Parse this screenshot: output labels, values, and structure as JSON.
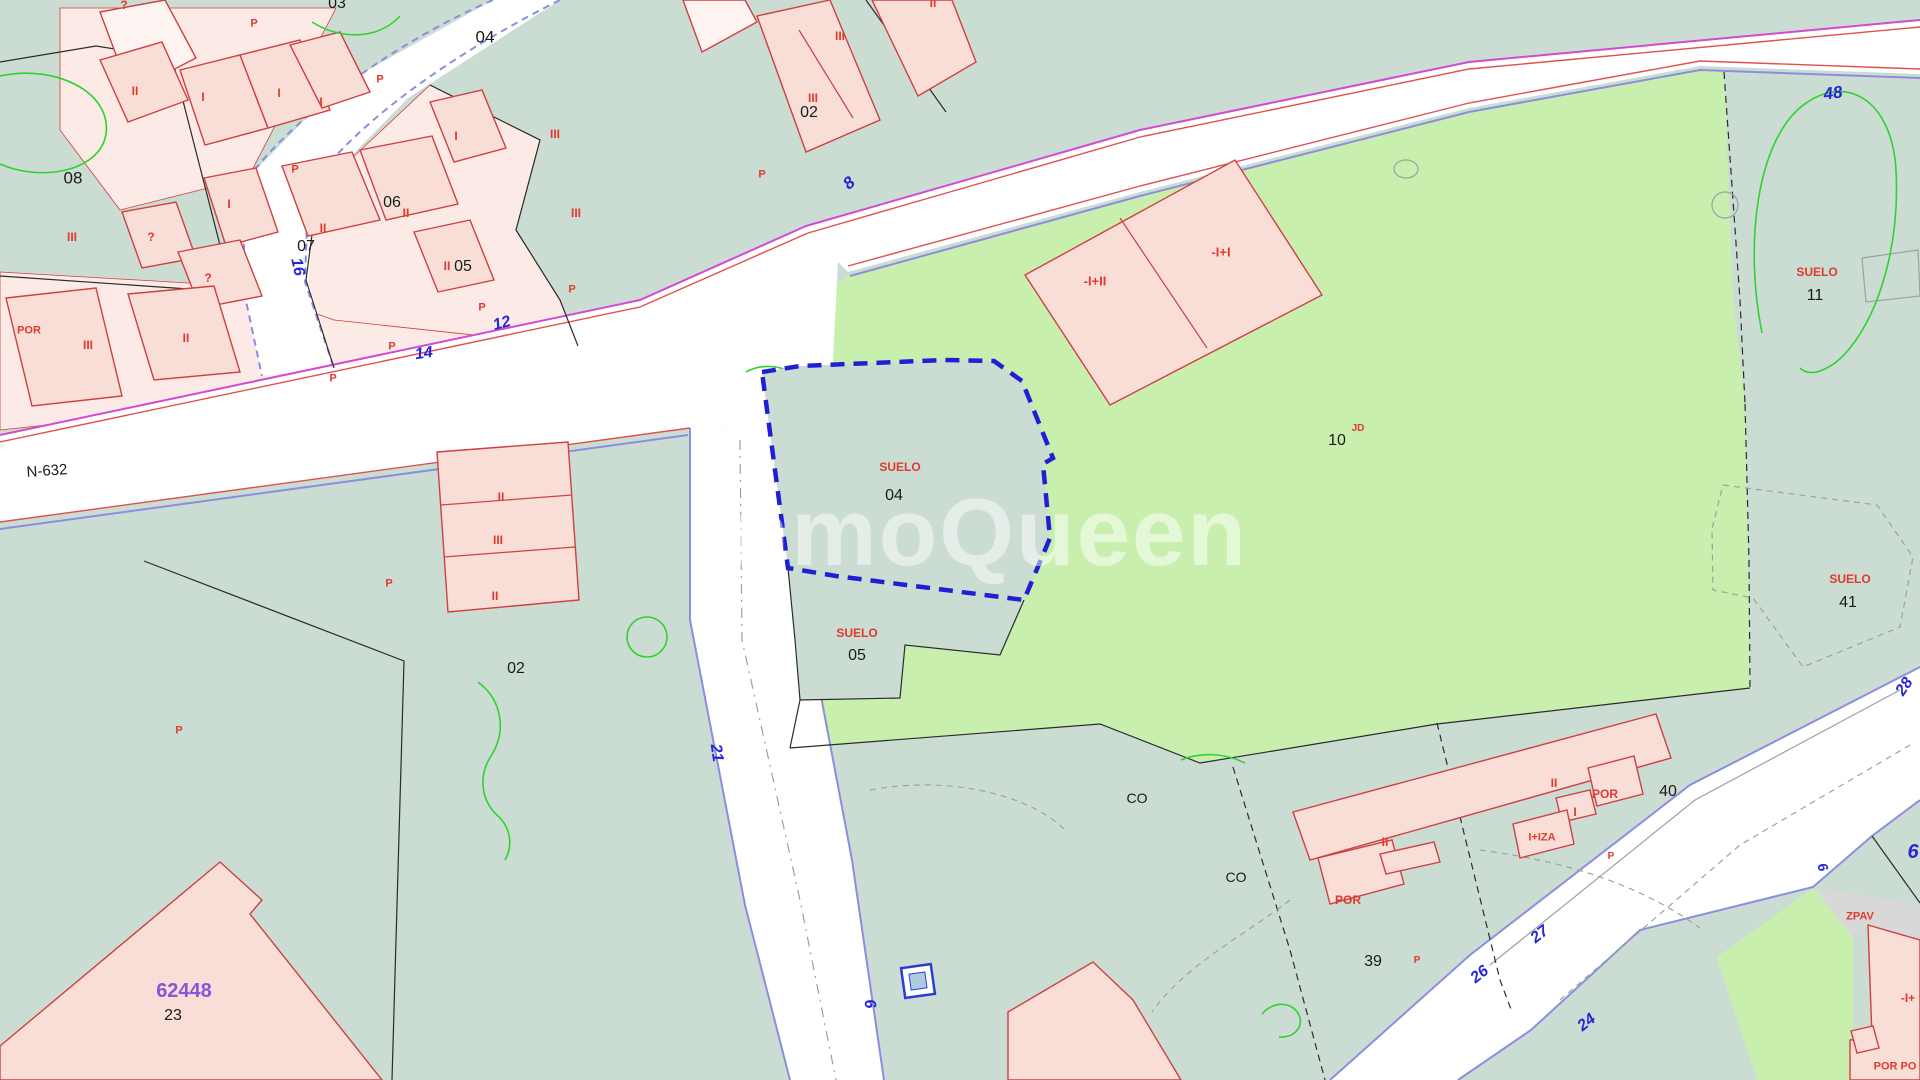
{
  "map": {
    "watermark_text": "InmoQueen",
    "colors": {
      "teal": "#cbdcd3",
      "light_green": "#c9efae",
      "road": "#ffffff",
      "parcel_pink": "#fbeae5",
      "building_pink": "#f8ded7",
      "building_outline": "#cf4040",
      "boundary": "#2b2b2b",
      "magenta": "#d24ad2",
      "red_edge": "#e05050",
      "violet": "#8d8de0",
      "selected_blue": "#1f1fd4",
      "label_black": "#1a1a1a",
      "label_red": "#e03a2f",
      "label_blue": "#2626d8",
      "label_purple": "#8756d6",
      "gray_fill": "#d8d8d8",
      "gray_line": "#9aa39e",
      "vegetation_green": "#2ed32e",
      "watermark_white": "#ffffff"
    },
    "selected_parcel": {
      "land_label": "SUELO",
      "number": "04"
    },
    "road_name": "N-632",
    "labels": [
      {
        "n": "parcel-number-03",
        "t": "03",
        "x": 337,
        "y": 4,
        "c": "black",
        "s": 16
      },
      {
        "n": "parcel-number-04",
        "t": "04",
        "x": 485,
        "y": 37,
        "c": "black",
        "s": 17
      },
      {
        "n": "parcel-number-08",
        "t": "08",
        "x": 73,
        "y": 178,
        "c": "black",
        "s": 17
      },
      {
        "n": "parcel-number-06",
        "t": "06",
        "x": 392,
        "y": 203,
        "c": "black",
        "s": 16
      },
      {
        "n": "parcel-number-07",
        "t": "07",
        "x": 306,
        "y": 247,
        "c": "black",
        "s": 16
      },
      {
        "n": "parcel-number-05",
        "t": "05",
        "x": 463,
        "y": 267,
        "c": "black",
        "s": 16
      },
      {
        "n": "parcel-number-02-top",
        "t": "02",
        "x": 809,
        "y": 113,
        "c": "black",
        "s": 16
      },
      {
        "n": "parcel-number-02",
        "t": "02",
        "x": 516,
        "y": 669,
        "c": "black",
        "s": 16
      },
      {
        "n": "suelo-04-label",
        "t": "SUELO",
        "x": 900,
        "y": 467,
        "c": "red",
        "s": 12
      },
      {
        "n": "parcel-number-04-suelo",
        "t": "04",
        "x": 894,
        "y": 496,
        "c": "black",
        "s": 16
      },
      {
        "n": "suelo-05-label",
        "t": "SUELO",
        "x": 857,
        "y": 633,
        "c": "red",
        "s": 12
      },
      {
        "n": "parcel-number-05-suelo",
        "t": "05",
        "x": 857,
        "y": 656,
        "c": "black",
        "s": 16
      },
      {
        "n": "parcel-number-10",
        "t": "10",
        "x": 1337,
        "y": 441,
        "c": "black",
        "s": 16
      },
      {
        "n": "landuse-jd",
        "t": "JD",
        "x": 1358,
        "y": 429,
        "c": "red",
        "s": 10
      },
      {
        "n": "suelo-11-label",
        "t": "SUELO",
        "x": 1817,
        "y": 272,
        "c": "red",
        "s": 12
      },
      {
        "n": "parcel-number-11",
        "t": "11",
        "x": 1815,
        "y": 296,
        "c": "black",
        "s": 16
      },
      {
        "n": "suelo-41-label",
        "t": "SUELO",
        "x": 1850,
        "y": 579,
        "c": "red",
        "s": 12
      },
      {
        "n": "parcel-number-41",
        "t": "41",
        "x": 1848,
        "y": 603,
        "c": "black",
        "s": 16
      },
      {
        "n": "parcel-number-40",
        "t": "40",
        "x": 1668,
        "y": 792,
        "c": "black",
        "s": 16
      },
      {
        "n": "parcel-number-39",
        "t": "39",
        "x": 1373,
        "y": 962,
        "c": "black",
        "s": 16
      },
      {
        "n": "parcel-number-23",
        "t": "23",
        "x": 173,
        "y": 1016,
        "c": "black",
        "s": 16
      },
      {
        "n": "cadastral-ref-62448",
        "t": "62448",
        "x": 184,
        "y": 991,
        "c": "purple",
        "s": 20
      },
      {
        "n": "landuse-co-1",
        "t": "CO",
        "x": 1137,
        "y": 798,
        "c": "black",
        "s": 14
      },
      {
        "n": "landuse-co-2",
        "t": "CO",
        "x": 1236,
        "y": 877,
        "c": "black",
        "s": 14
      },
      {
        "n": "road-name-n632",
        "t": "N-632",
        "x": 47,
        "y": 471,
        "c": "black",
        "s": 15,
        "r": -4
      },
      {
        "n": "mark-q-1",
        "t": "?",
        "x": 124,
        "y": 5,
        "c": "red",
        "s": 12
      },
      {
        "n": "ground-mark-p-1",
        "t": "P",
        "x": 254,
        "y": 24,
        "c": "red",
        "s": 11
      },
      {
        "n": "ground-mark-p-2",
        "t": "P",
        "x": 380,
        "y": 80,
        "c": "red",
        "s": 11
      },
      {
        "n": "floors-ii-1",
        "t": "II",
        "x": 135,
        "y": 91,
        "c": "red",
        "s": 12
      },
      {
        "n": "floors-i-1",
        "t": "I",
        "x": 203,
        "y": 97,
        "c": "red",
        "s": 12
      },
      {
        "n": "floors-i-2",
        "t": "I",
        "x": 279,
        "y": 93,
        "c": "red",
        "s": 12
      },
      {
        "n": "floors-i-3",
        "t": "I",
        "x": 321,
        "y": 102,
        "c": "red",
        "s": 12
      },
      {
        "n": "floors-i-4",
        "t": "I",
        "x": 456,
        "y": 136,
        "c": "red",
        "s": 12
      },
      {
        "n": "ground-mark-p-3",
        "t": "P",
        "x": 295,
        "y": 170,
        "c": "red",
        "s": 11
      },
      {
        "n": "floors-i-5",
        "t": "I",
        "x": 229,
        "y": 204,
        "c": "red",
        "s": 12
      },
      {
        "n": "floors-ii-2",
        "t": "II",
        "x": 406,
        "y": 213,
        "c": "red",
        "s": 12
      },
      {
        "n": "floors-ii-3",
        "t": "II",
        "x": 323,
        "y": 228,
        "c": "red",
        "s": 12
      },
      {
        "n": "floors-iii-1",
        "t": "III",
        "x": 72,
        "y": 237,
        "c": "red",
        "s": 12
      },
      {
        "n": "mark-q-2",
        "t": "?",
        "x": 151,
        "y": 237,
        "c": "red",
        "s": 12
      },
      {
        "n": "floors-ii-4",
        "t": "II",
        "x": 447,
        "y": 266,
        "c": "red",
        "s": 12
      },
      {
        "n": "mark-q-3",
        "t": "?",
        "x": 208,
        "y": 278,
        "c": "red",
        "s": 12
      },
      {
        "n": "floors-por-1",
        "t": "POR",
        "x": 29,
        "y": 331,
        "c": "red",
        "s": 11
      },
      {
        "n": "floors-iii-2",
        "t": "III",
        "x": 88,
        "y": 345,
        "c": "red",
        "s": 12
      },
      {
        "n": "floors-ii-5",
        "t": "II",
        "x": 186,
        "y": 338,
        "c": "red",
        "s": 12
      },
      {
        "n": "ground-mark-p-4",
        "t": "P",
        "x": 482,
        "y": 308,
        "c": "red",
        "s": 11
      },
      {
        "n": "ground-mark-p-5",
        "t": "P",
        "x": 333,
        "y": 379,
        "c": "red",
        "s": 11
      },
      {
        "n": "ground-mark-p-6",
        "t": "P",
        "x": 392,
        "y": 347,
        "c": "red",
        "s": 11
      },
      {
        "n": "floors-iii-3",
        "t": "III",
        "x": 555,
        "y": 134,
        "c": "red",
        "s": 12
      },
      {
        "n": "floors-iii-4",
        "t": "III",
        "x": 576,
        "y": 213,
        "c": "red",
        "s": 12
      },
      {
        "n": "ground-mark-p-7",
        "t": "P",
        "x": 572,
        "y": 290,
        "c": "red",
        "s": 11
      },
      {
        "n": "floors-iii-5",
        "t": "III",
        "x": 840,
        "y": 36,
        "c": "red",
        "s": 12
      },
      {
        "n": "floors-iii-6",
        "t": "III",
        "x": 813,
        "y": 98,
        "c": "red",
        "s": 12
      },
      {
        "n": "floors-ii-6",
        "t": "II",
        "x": 933,
        "y": 3,
        "c": "red",
        "s": 12
      },
      {
        "n": "ground-mark-p-8",
        "t": "P",
        "x": 762,
        "y": 175,
        "c": "red",
        "s": 11
      },
      {
        "n": "floors-ii-7",
        "t": "II",
        "x": 501,
        "y": 497,
        "c": "red",
        "s": 12
      },
      {
        "n": "floors-iii-7",
        "t": "III",
        "x": 498,
        "y": 540,
        "c": "red",
        "s": 12
      },
      {
        "n": "floors-ii-8",
        "t": "II",
        "x": 495,
        "y": 596,
        "c": "red",
        "s": 12
      },
      {
        "n": "ground-mark-p-9",
        "t": "P",
        "x": 389,
        "y": 584,
        "c": "red",
        "s": 11
      },
      {
        "n": "ground-mark-p-10",
        "t": "P",
        "x": 179,
        "y": 731,
        "c": "red",
        "s": 11
      },
      {
        "n": "floors-neg-i-ii",
        "t": "-I+II",
        "x": 1095,
        "y": 281,
        "c": "red",
        "s": 13
      },
      {
        "n": "floors-neg-i-i",
        "t": "-I+I",
        "x": 1221,
        "y": 252,
        "c": "red",
        "s": 13
      },
      {
        "n": "floors-ii-9",
        "t": "II",
        "x": 1554,
        "y": 783,
        "c": "red",
        "s": 12
      },
      {
        "n": "floors-por-2",
        "t": "POR",
        "x": 1605,
        "y": 794,
        "c": "red",
        "s": 12
      },
      {
        "n": "floors-i-6",
        "t": "I",
        "x": 1575,
        "y": 812,
        "c": "red",
        "s": 12
      },
      {
        "n": "floors-i-iza",
        "t": "I+IZA",
        "x": 1542,
        "y": 838,
        "c": "red",
        "s": 11
      },
      {
        "n": "floors-ii-10",
        "t": "II",
        "x": 1385,
        "y": 842,
        "c": "red",
        "s": 12
      },
      {
        "n": "floors-por-3",
        "t": "POR",
        "x": 1348,
        "y": 900,
        "c": "red",
        "s": 12
      },
      {
        "n": "ground-mark-p-11",
        "t": "P",
        "x": 1611,
        "y": 857,
        "c": "red",
        "s": 10
      },
      {
        "n": "ground-mark-p-12",
        "t": "P",
        "x": 1417,
        "y": 961,
        "c": "red",
        "s": 10
      },
      {
        "n": "landuse-zpav",
        "t": "ZPAV",
        "x": 1860,
        "y": 917,
        "c": "red",
        "s": 11
      },
      {
        "n": "floors-neg-i",
        "t": "-I+",
        "x": 1908,
        "y": 998,
        "c": "red",
        "s": 12
      },
      {
        "n": "floors-por-4",
        "t": "POR PO",
        "x": 1895,
        "y": 1067,
        "c": "red",
        "s": 11
      },
      {
        "n": "street-number-16",
        "t": "16",
        "x": 297,
        "y": 267,
        "c": "blue",
        "s": 16,
        "r": 78
      },
      {
        "n": "street-number-14",
        "t": "14",
        "x": 424,
        "y": 354,
        "c": "blue",
        "s": 16,
        "r": -8
      },
      {
        "n": "street-number-12",
        "t": "12",
        "x": 502,
        "y": 324,
        "c": "blue",
        "s": 16,
        "r": -15
      },
      {
        "n": "street-number-8",
        "t": "8",
        "x": 849,
        "y": 183,
        "c": "blue",
        "s": 17,
        "r": -40
      },
      {
        "n": "street-number-48",
        "t": "48",
        "x": 1833,
        "y": 93,
        "c": "blue",
        "s": 17,
        "r": -8
      },
      {
        "n": "street-number-21",
        "t": "21",
        "x": 716,
        "y": 753,
        "c": "blue",
        "s": 16,
        "r": 82
      },
      {
        "n": "street-number-6a",
        "t": "6",
        "x": 869,
        "y": 1004,
        "c": "blue",
        "s": 16,
        "r": 80
      },
      {
        "n": "street-number-27",
        "t": "27",
        "x": 1540,
        "y": 935,
        "c": "blue",
        "s": 16,
        "r": -38
      },
      {
        "n": "street-number-26",
        "t": "26",
        "x": 1480,
        "y": 975,
        "c": "blue",
        "s": 16,
        "r": -38
      },
      {
        "n": "street-number-24",
        "t": "24",
        "x": 1587,
        "y": 1023,
        "c": "blue",
        "s": 16,
        "r": -38
      },
      {
        "n": "street-number-28",
        "t": "28",
        "x": 1905,
        "y": 687,
        "c": "blue",
        "s": 16,
        "r": -55
      },
      {
        "n": "street-number-6b",
        "t": "6",
        "x": 1823,
        "y": 867,
        "c": "blue",
        "s": 14,
        "r": 70
      },
      {
        "n": "street-number-6c",
        "t": "6",
        "x": 1913,
        "y": 852,
        "c": "blue",
        "s": 20,
        "r": 0
      }
    ]
  }
}
